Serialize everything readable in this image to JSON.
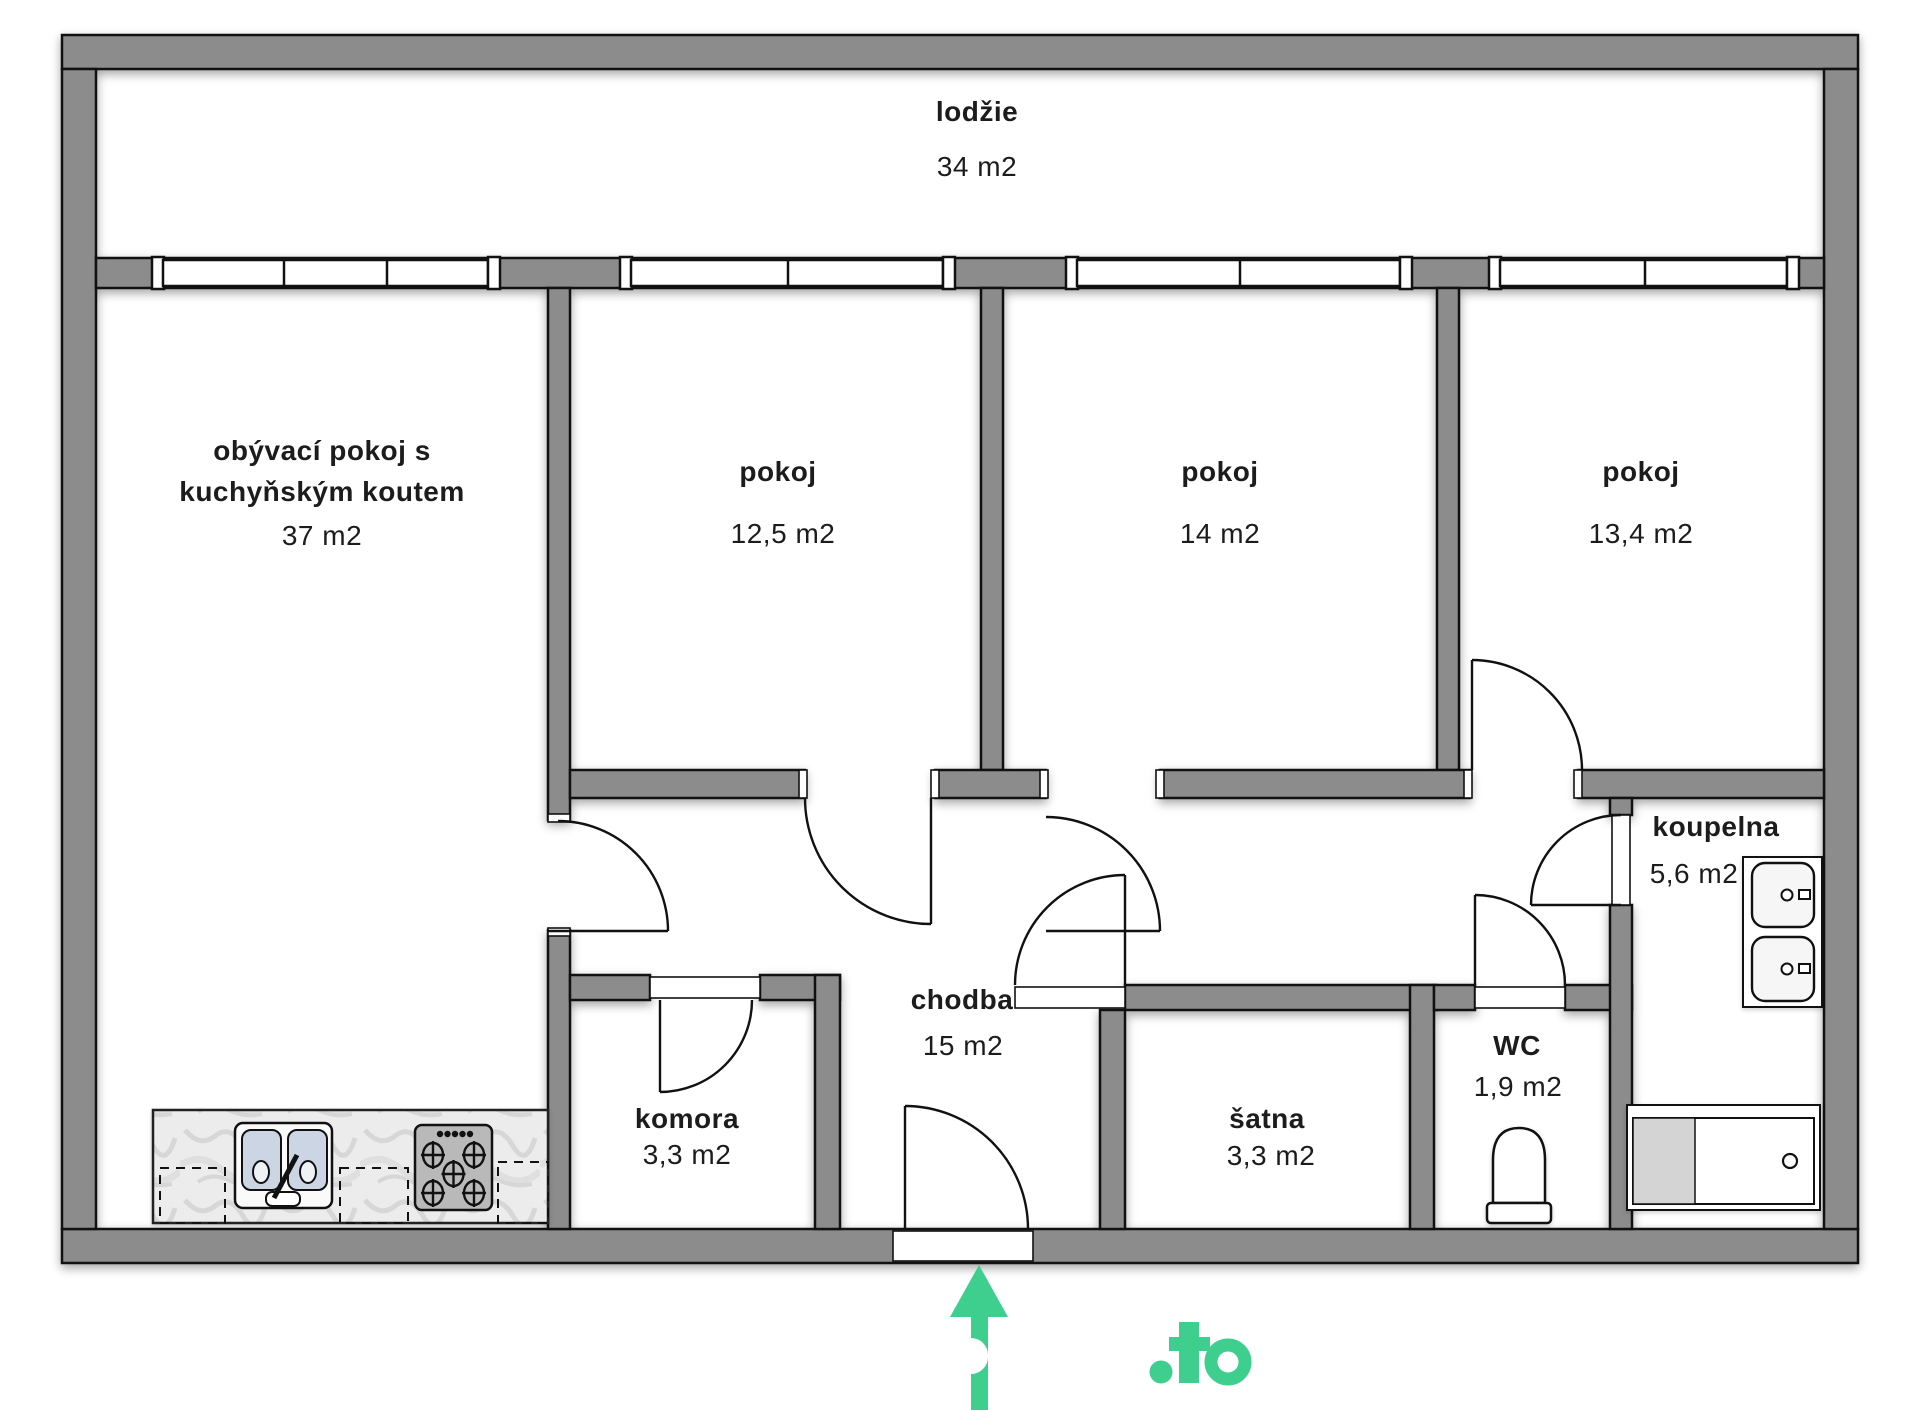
{
  "rooms": {
    "lodzie": {
      "name": "lodžie",
      "area": "34 m2"
    },
    "living": {
      "name_line1": "obývací pokoj s",
      "name_line2": "kuchyňským koutem",
      "area": "37 m2"
    },
    "pokoj_left": {
      "name": "pokoj",
      "area": "12,5 m2"
    },
    "pokoj_middle": {
      "name": "pokoj",
      "area": "14 m2"
    },
    "pokoj_right": {
      "name": "pokoj",
      "area": "13,4 m2"
    },
    "chodba": {
      "name": "chodba",
      "area": "15 m2"
    },
    "komora": {
      "name": "komora",
      "area": "3,3 m2"
    },
    "satna": {
      "name": "šatna",
      "area": "3,3 m2"
    },
    "wc": {
      "name": "WC",
      "area": "1,9 m2"
    },
    "koupelna": {
      "name": "koupelna",
      "area": "5,6 m2"
    }
  },
  "branding": {
    "logo_text": ".to"
  },
  "icons": {
    "entrance_marker": "arrow-up-icon"
  },
  "colors": {
    "wall_gray": "#8C8C8C",
    "accent_green": "#3ECE8E",
    "line_black": "#111111"
  }
}
